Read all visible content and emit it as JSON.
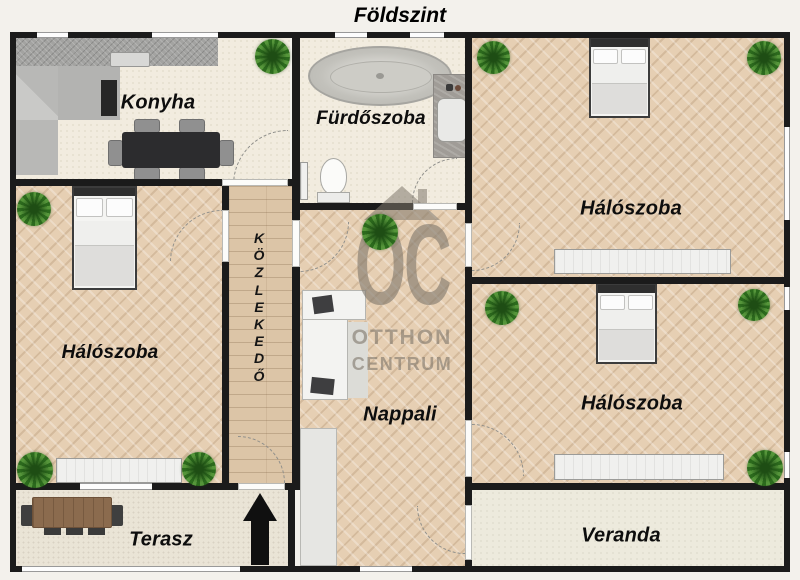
{
  "title": "Földszint",
  "watermark": {
    "logo": "OC",
    "line1": "OTTHON",
    "line2": "CENTRUM"
  },
  "rooms": {
    "kitchen": {
      "label": "Konyha"
    },
    "bathroom": {
      "label": "Fürdőszoba"
    },
    "bedroom_top_right": {
      "label": "Hálószoba"
    },
    "bedroom_left": {
      "label": "Hálószoba"
    },
    "bedroom_bottom_right": {
      "label": "Hálószoba"
    },
    "hallway": {
      "label": "KÖZLEKEDŐ"
    },
    "living_room": {
      "label": "Nappali"
    },
    "terrace": {
      "label": "Terasz"
    },
    "veranda": {
      "label": "Veranda"
    }
  },
  "icons": {
    "plant": "potted-plant-icon",
    "entrance_arrow": "entrance-arrow-icon",
    "watermark_house": "house-roof-icon"
  },
  "colors": {
    "wall": "#1b1b1b",
    "parquet": "#e6cfb3",
    "hallway_planks": "#dcc5a7",
    "cream_floor": "#f2ecdf",
    "terrace_floor": "#eae4d6",
    "veranda_floor": "#edeadd",
    "watermark_gray": "#80786c",
    "plant_green": "#3f7d2b",
    "entrance_arrow": "#101010"
  }
}
